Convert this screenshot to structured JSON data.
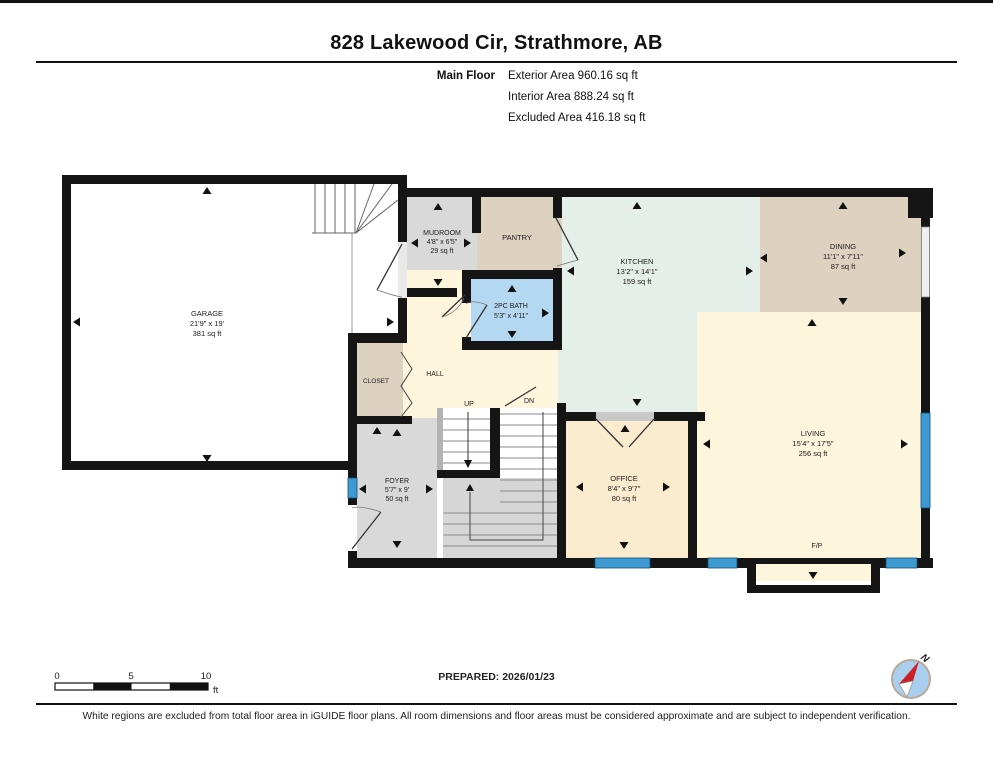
{
  "header": {
    "title": "828 Lakewood Cir, Strathmore, AB",
    "floor_label": "Main Floor",
    "exterior": "Exterior Area 960.16 sq ft",
    "interior": "Interior Area 888.24 sq ft",
    "excluded": "Excluded Area 416.18 sq ft"
  },
  "rooms": {
    "garage": {
      "name": "GARAGE",
      "dims": "21'9\" x 19'",
      "area": "381 sq ft"
    },
    "mudroom": {
      "name": "MUDROOM",
      "dims": "4'8\" x 6'5\"",
      "area": "29 sq ft"
    },
    "pantry": {
      "name": "PANTRY"
    },
    "kitchen": {
      "name": "KITCHEN",
      "dims": "13'2\" x 14'1\"",
      "area": "159 sq ft"
    },
    "dining": {
      "name": "DINING",
      "dims": "11'1\" x 7'11\"",
      "area": "87 sq ft"
    },
    "bath": {
      "name": "2PC BATH",
      "dims": "5'3\" x 4'11\""
    },
    "closet": {
      "name": "CLOSET"
    },
    "hall": {
      "name": "HALL"
    },
    "foyer": {
      "name": "FOYER",
      "dims": "5'7\" x 9'",
      "area": "50 sq ft"
    },
    "office": {
      "name": "OFFICE",
      "dims": "8'4\" x 9'7\"",
      "area": "80 sq ft"
    },
    "living": {
      "name": "LIVING",
      "dims": "15'4\" x 17'5\"",
      "area": "256 sq ft"
    },
    "fireplace": {
      "name": "F/P"
    }
  },
  "stairs": {
    "up": "UP",
    "dn": "DN"
  },
  "scale_bar": {
    "t0": "0",
    "t5": "5",
    "t10": "10",
    "unit": "ft"
  },
  "prepared_label": "PREPARED: 2026/01/23",
  "compass": {
    "north": "N"
  },
  "disclaimer": "White regions are excluded from total floor area in iGUIDE floor plans. All room dimensions and floor areas must be considered approximate and are subject to independent verification.",
  "colors": {
    "wall": "#151515",
    "garage": "#ffffff",
    "gray_room": "#d9d9d9",
    "tan_room": "#ddd1c0",
    "kitchen": "#e4efe9",
    "bath": "#b4d8f1",
    "cream_room": "#fdf6dd",
    "office": "#fbeccf",
    "window": "#3f9ad2",
    "compass_circle": "#aacfee",
    "compass_needle": "#cc2027"
  }
}
